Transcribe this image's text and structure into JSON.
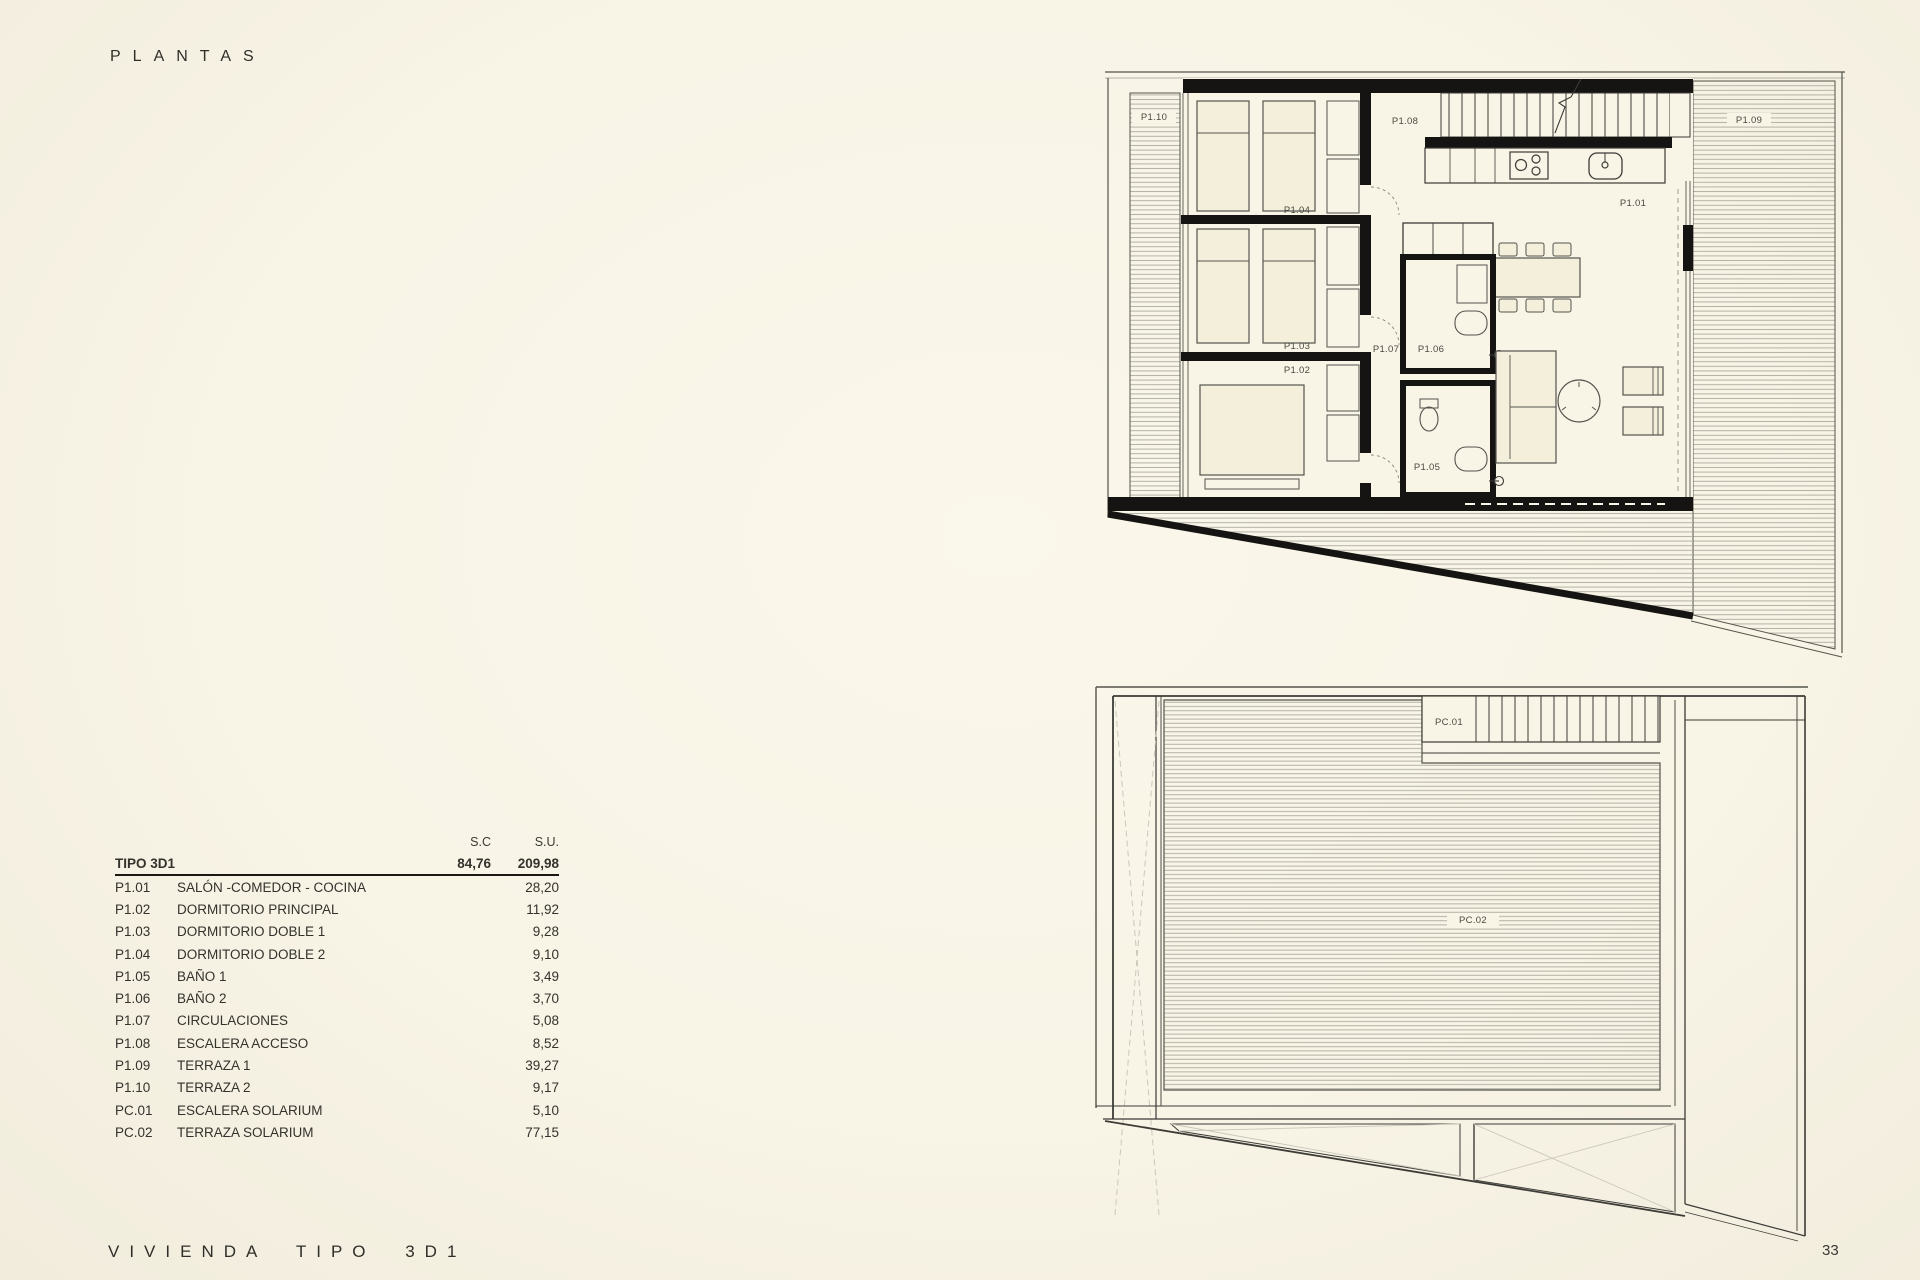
{
  "page": {
    "title": "PLANTAS",
    "footer": "VIVIENDA TIPO 3D1",
    "page_number": "33"
  },
  "colors": {
    "paper": "#f8f4e6",
    "wall": "#151412",
    "line": "#3c3b36",
    "hatch": "#b2b1a5",
    "furniture_fill": "#f4efdb"
  },
  "area_table": {
    "columns": {
      "sc": "S.C",
      "su": "S.U."
    },
    "group": {
      "label": "TIPO 3D1",
      "sc": "84,76",
      "su": "209,98"
    },
    "rows": [
      {
        "code": "P1.01",
        "name": "SALÓN -COMEDOR - COCINA",
        "su": "28,20"
      },
      {
        "code": "P1.02",
        "name": "DORMITORIO PRINCIPAL",
        "su": "11,92"
      },
      {
        "code": "P1.03",
        "name": "DORMITORIO DOBLE 1",
        "su": "9,28"
      },
      {
        "code": "P1.04",
        "name": "DORMITORIO DOBLE 2",
        "su": "9,10"
      },
      {
        "code": "P1.05",
        "name": "BAÑO 1",
        "su": "3,49"
      },
      {
        "code": "P1.06",
        "name": "BAÑO 2",
        "su": "3,70"
      },
      {
        "code": "P1.07",
        "name": "CIRCULACIONES",
        "su": "5,08"
      },
      {
        "code": "P1.08",
        "name": "ESCALERA ACCESO",
        "su": "8,52"
      },
      {
        "code": "P1.09",
        "name": "TERRAZA 1",
        "su": "39,27"
      },
      {
        "code": "P1.10",
        "name": "TERRAZA 2",
        "su": "9,17"
      },
      {
        "code": "PC.01",
        "name": "ESCALERA SOLARIUM",
        "su": "5,10"
      },
      {
        "code": "PC.02",
        "name": "TERRAZA SOLARIUM",
        "su": "77,15"
      }
    ]
  },
  "plans": {
    "upper": {
      "labels": {
        "p101": "P1.01",
        "p102": "P1.02",
        "p103": "P1.03",
        "p104": "P1.04",
        "p105": "P1.05",
        "p106": "P1.06",
        "p107": "P1.07",
        "p108": "P1.08",
        "p109": "P1.09",
        "p110": "P1.10"
      }
    },
    "lower": {
      "labels": {
        "pc01": "PC.01",
        "pc02": "PC.02"
      }
    }
  }
}
